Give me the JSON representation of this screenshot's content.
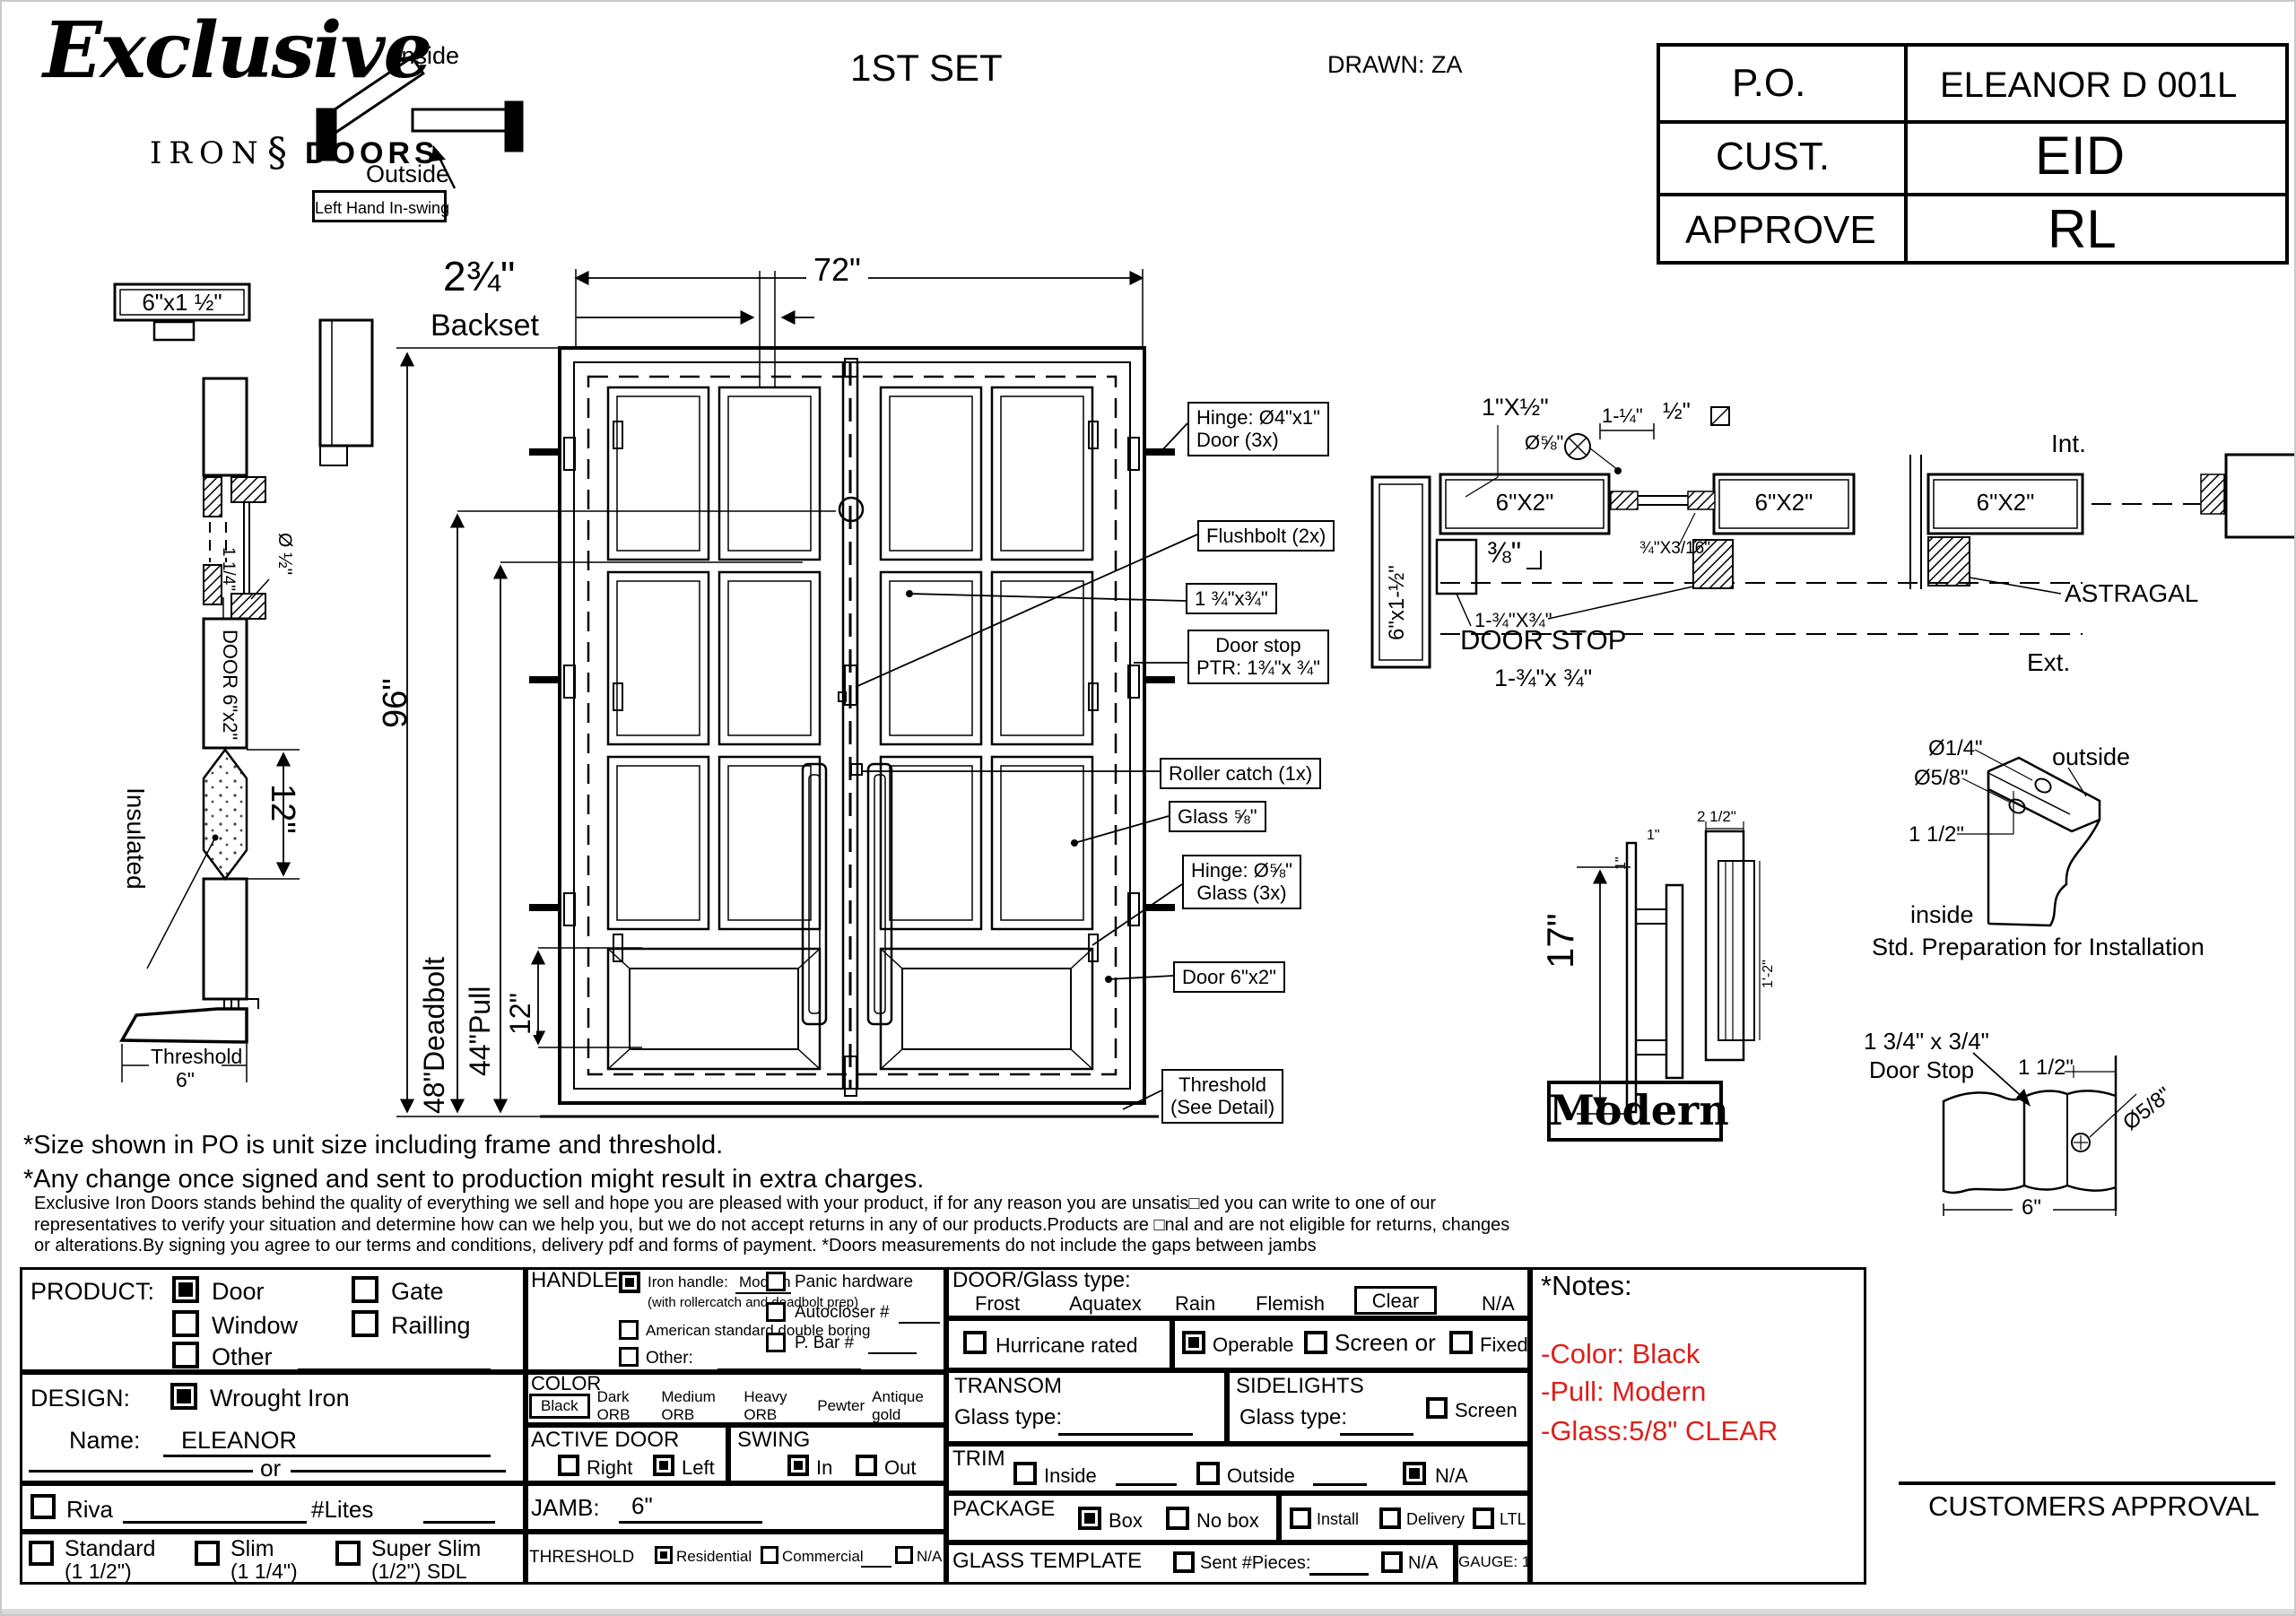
{
  "colors": {
    "red": "#dd1f1a",
    "ink": "#000000"
  },
  "header": {
    "logo_script": "Exclusive",
    "logo_iron": "IRON",
    "logo_fleur": "§",
    "logo_doors": "DOORS",
    "set_title": "1ST SET",
    "drawn": "DRAWN: ZA"
  },
  "swing": {
    "inside": "Inside",
    "outside": "Outside",
    "hand": "Left Hand In-swing"
  },
  "po": {
    "r1l": "P.O.",
    "r1v": "ELEANOR D 001L",
    "r2l": "CUST.",
    "r2v": "EID",
    "r3l": "APPROVE",
    "r3v": "RL"
  },
  "jamb": {
    "top_label": "6\"x1 ½\"",
    "glass_dia": "Ø ½\"",
    "stop": "1 1/4\"",
    "door": "DOOR 6\"x2\"",
    "insulated": "Insulated",
    "rail": "12\"",
    "threshold": "Threshold",
    "threshold_w": "6\""
  },
  "elev": {
    "w": "72\"",
    "backset_v": "2¾\"",
    "backset": "Backset",
    "h": "96\"",
    "deadbolt": "48\"Deadbolt",
    "pull": "44\"Pull",
    "rail": "12\"",
    "c_hinge1": "Hinge: Ø4\"x1\"",
    "c_hinge2": "Door (3x)",
    "c_flush": "Flushbolt (2x)",
    "c_size": "1 ¾\"x¾\"",
    "c_stop1": "Door stop",
    "c_stop2": "PTR: 1¾\"x ¾\"",
    "c_roller": "Roller catch  (1x)",
    "c_glass": "Glass ⅝\"",
    "c_ghinge1": "Hinge: Ø⅝\"",
    "c_ghinge2": "Glass (3x)",
    "c_tube": "Door 6\"x2\"",
    "c_thr1": "Threshold",
    "c_thr2": "(See Detail)"
  },
  "head": {
    "astragal_bar": "1\"X½\"",
    "screw": "Ø⅝\"",
    "dim114": "1-¼\"",
    "dim12": "½\"",
    "tube1": "6\"X2\"",
    "tube2": "6\"X2\"",
    "tube3": "6\"X2\"",
    "dim38": "⅜\"",
    "bead": "¾\"X3/16\"",
    "stop_sz": "1-¾\"X¾\"",
    "jamb_rot": "6\"x1-½\"",
    "ds1": "DOOR STOP",
    "ds2": "1-¾\"x ¾\"",
    "int": "Int.",
    "ext": "Ext.",
    "astragal": "ASTRAGAL"
  },
  "handle": {
    "h": "17\"",
    "one_a": "1\"",
    "one_b": "1\"",
    "w": "2 1/2\"",
    "len": "1'-2\"",
    "name": "Modern"
  },
  "install": {
    "small": "Ø1/4\"",
    "big": "Ø5/8\"",
    "off": "1 1/2\"",
    "outside": "outside",
    "inside": "inside",
    "cap": "Std. Preparation for Installation"
  },
  "stopd": {
    "size": "1 3/4\" x 3/4\"",
    "name": "Door Stop",
    "off": "1 1/2\"",
    "dia": "Ø5/8\"",
    "w": "6\""
  },
  "notes": {
    "l1": "*Size shown in PO is unit size including frame and threshold.",
    "l2": "*Any change once signed and sent to production might result in extra charges.",
    "f1": "Exclusive Iron Doors stands behind the quality of everything we sell and hope you are pleased with your product, if for any reason you are unsatis□ed you can write to one of our",
    "f2": "representatives to verify your situation and determine how can we help you, but we do not accept returns in any of our products.Products are □nal and are not eligible for returns, changes",
    "f3": "or alterations.By signing you agree to our terms and conditions, delivery pdf and forms of payment. *Doors measurements do not include the gaps between jambs"
  },
  "form": {
    "product": {
      "title": "PRODUCT:",
      "door": "Door",
      "gate": "Gate",
      "window": "Window",
      "railing": "Railling",
      "other": "Other",
      "door_on": true
    },
    "design": {
      "title": "DESIGN:",
      "wrought": "Wrought Iron",
      "wrought_on": true,
      "name_l": "Name:",
      "name_v": "ELEANOR",
      "or": "or",
      "riva": "Riva",
      "lites": "#Lites",
      "std1": "Standard",
      "std2": "(1 1/2\")",
      "slim1": "Slim",
      "slim2": "(1 1/4\")",
      "super1": "Super Slim",
      "super2": "(1/2\") SDL"
    },
    "handle": {
      "title": "HANDLE",
      "iron": "Iron handle:",
      "iron_v": "Modern",
      "iron_on": true,
      "note": "(with rollercatch and deadbolt prep)",
      "american": "American standard double boring",
      "other": "Other:",
      "panic": "Panic hardware",
      "auto": "Autocloser #",
      "pbar": "P. Bar #"
    },
    "color": {
      "title": "COLOR",
      "black": "Black",
      "dark": "Dark ORB",
      "medium": "Medium ORB",
      "heavy": "Heavy ORB",
      "pewter": "Pewter",
      "antique": "Antique gold"
    },
    "active": {
      "title": "ACTIVE DOOR",
      "right": "Right",
      "left": "Left",
      "left_on": true
    },
    "swing": {
      "title": "SWING",
      "in": "In",
      "out": "Out",
      "in_on": true
    },
    "jamb": {
      "title": "JAMB:",
      "v": "6\""
    },
    "thr": {
      "title": "THRESHOLD",
      "res": "Residential",
      "res_on": true,
      "com": "Commercial",
      "na": "N/A"
    },
    "glass": {
      "title": "DOOR/Glass type:",
      "frost": "Frost",
      "aquatex": "Aquatex",
      "rain": "Rain",
      "flemish": "Flemish",
      "clear": "Clear",
      "na": "N/A"
    },
    "hurr": {
      "label": "Hurricane rated"
    },
    "oper": {
      "operable": "Operable",
      "operable_on": true,
      "screen": "Screen or",
      "fixed": "Fixed"
    },
    "transom": {
      "title": "TRANSOM",
      "gt": "Glass type:"
    },
    "side": {
      "title": "SIDELIGHTS",
      "gt": "Glass type:",
      "screen": "Screen"
    },
    "trim": {
      "title": "TRIM",
      "inside": "Inside",
      "outside": "Outside",
      "na": "N/A",
      "na_on": true
    },
    "pack": {
      "title": "PACKAGE",
      "box": "Box",
      "box_on": true,
      "nobox": "No box",
      "install": "Install",
      "delivery": "Delivery",
      "ltl": "LTL"
    },
    "tmpl": {
      "title": "GLASS TEMPLATE",
      "sent": "Sent #Pieces:",
      "na": "N/A",
      "gauge": "GAUGE: 14"
    },
    "notes": {
      "title": "*Notes:",
      "c": "-Color: Black",
      "p": "-Pull: Modern",
      "g": "-Glass:5/8\" CLEAR"
    }
  },
  "approval": "CUSTOMERS APPROVAL"
}
